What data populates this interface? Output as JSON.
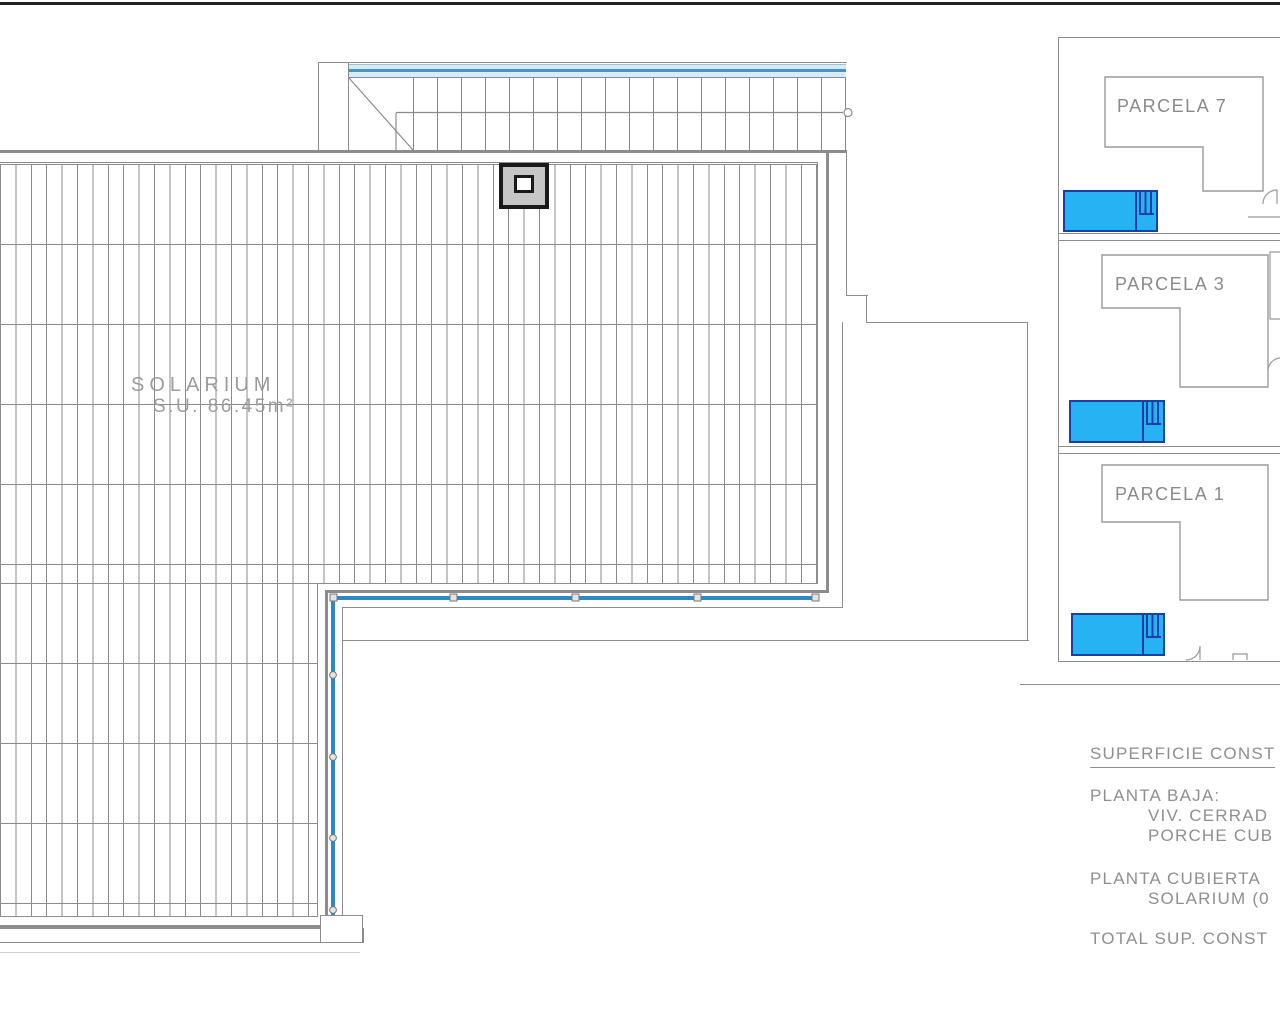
{
  "plan": {
    "solarium": {
      "label": "SOLARIUM",
      "area": "S.U. 86.45m²"
    }
  },
  "sidebar": {
    "parcels": [
      {
        "label": "PARCELA 7"
      },
      {
        "label": "PARCELA 3"
      },
      {
        "label": "PARCELA 1"
      }
    ]
  },
  "summary": {
    "title": "SUPERFICIE CONST",
    "planta_baja": "PLANTA BAJA:",
    "viv_cerrada": "VIV. CERRAD",
    "porche": "PORCHE CUB",
    "planta_cubierta": "PLANTA CUBIERTA",
    "solarium_item": "SOLARIUM (0",
    "total": "TOTAL SUP. CONST"
  },
  "colors": {
    "pool_fill": "#27b2f4",
    "pool_border": "#1c3fa4",
    "railing_blue": "#2f88c2",
    "stair_band_blue": "#d7ebf7",
    "line_gray": "#8c8c8c",
    "text_gray": "#8f8f8f"
  }
}
